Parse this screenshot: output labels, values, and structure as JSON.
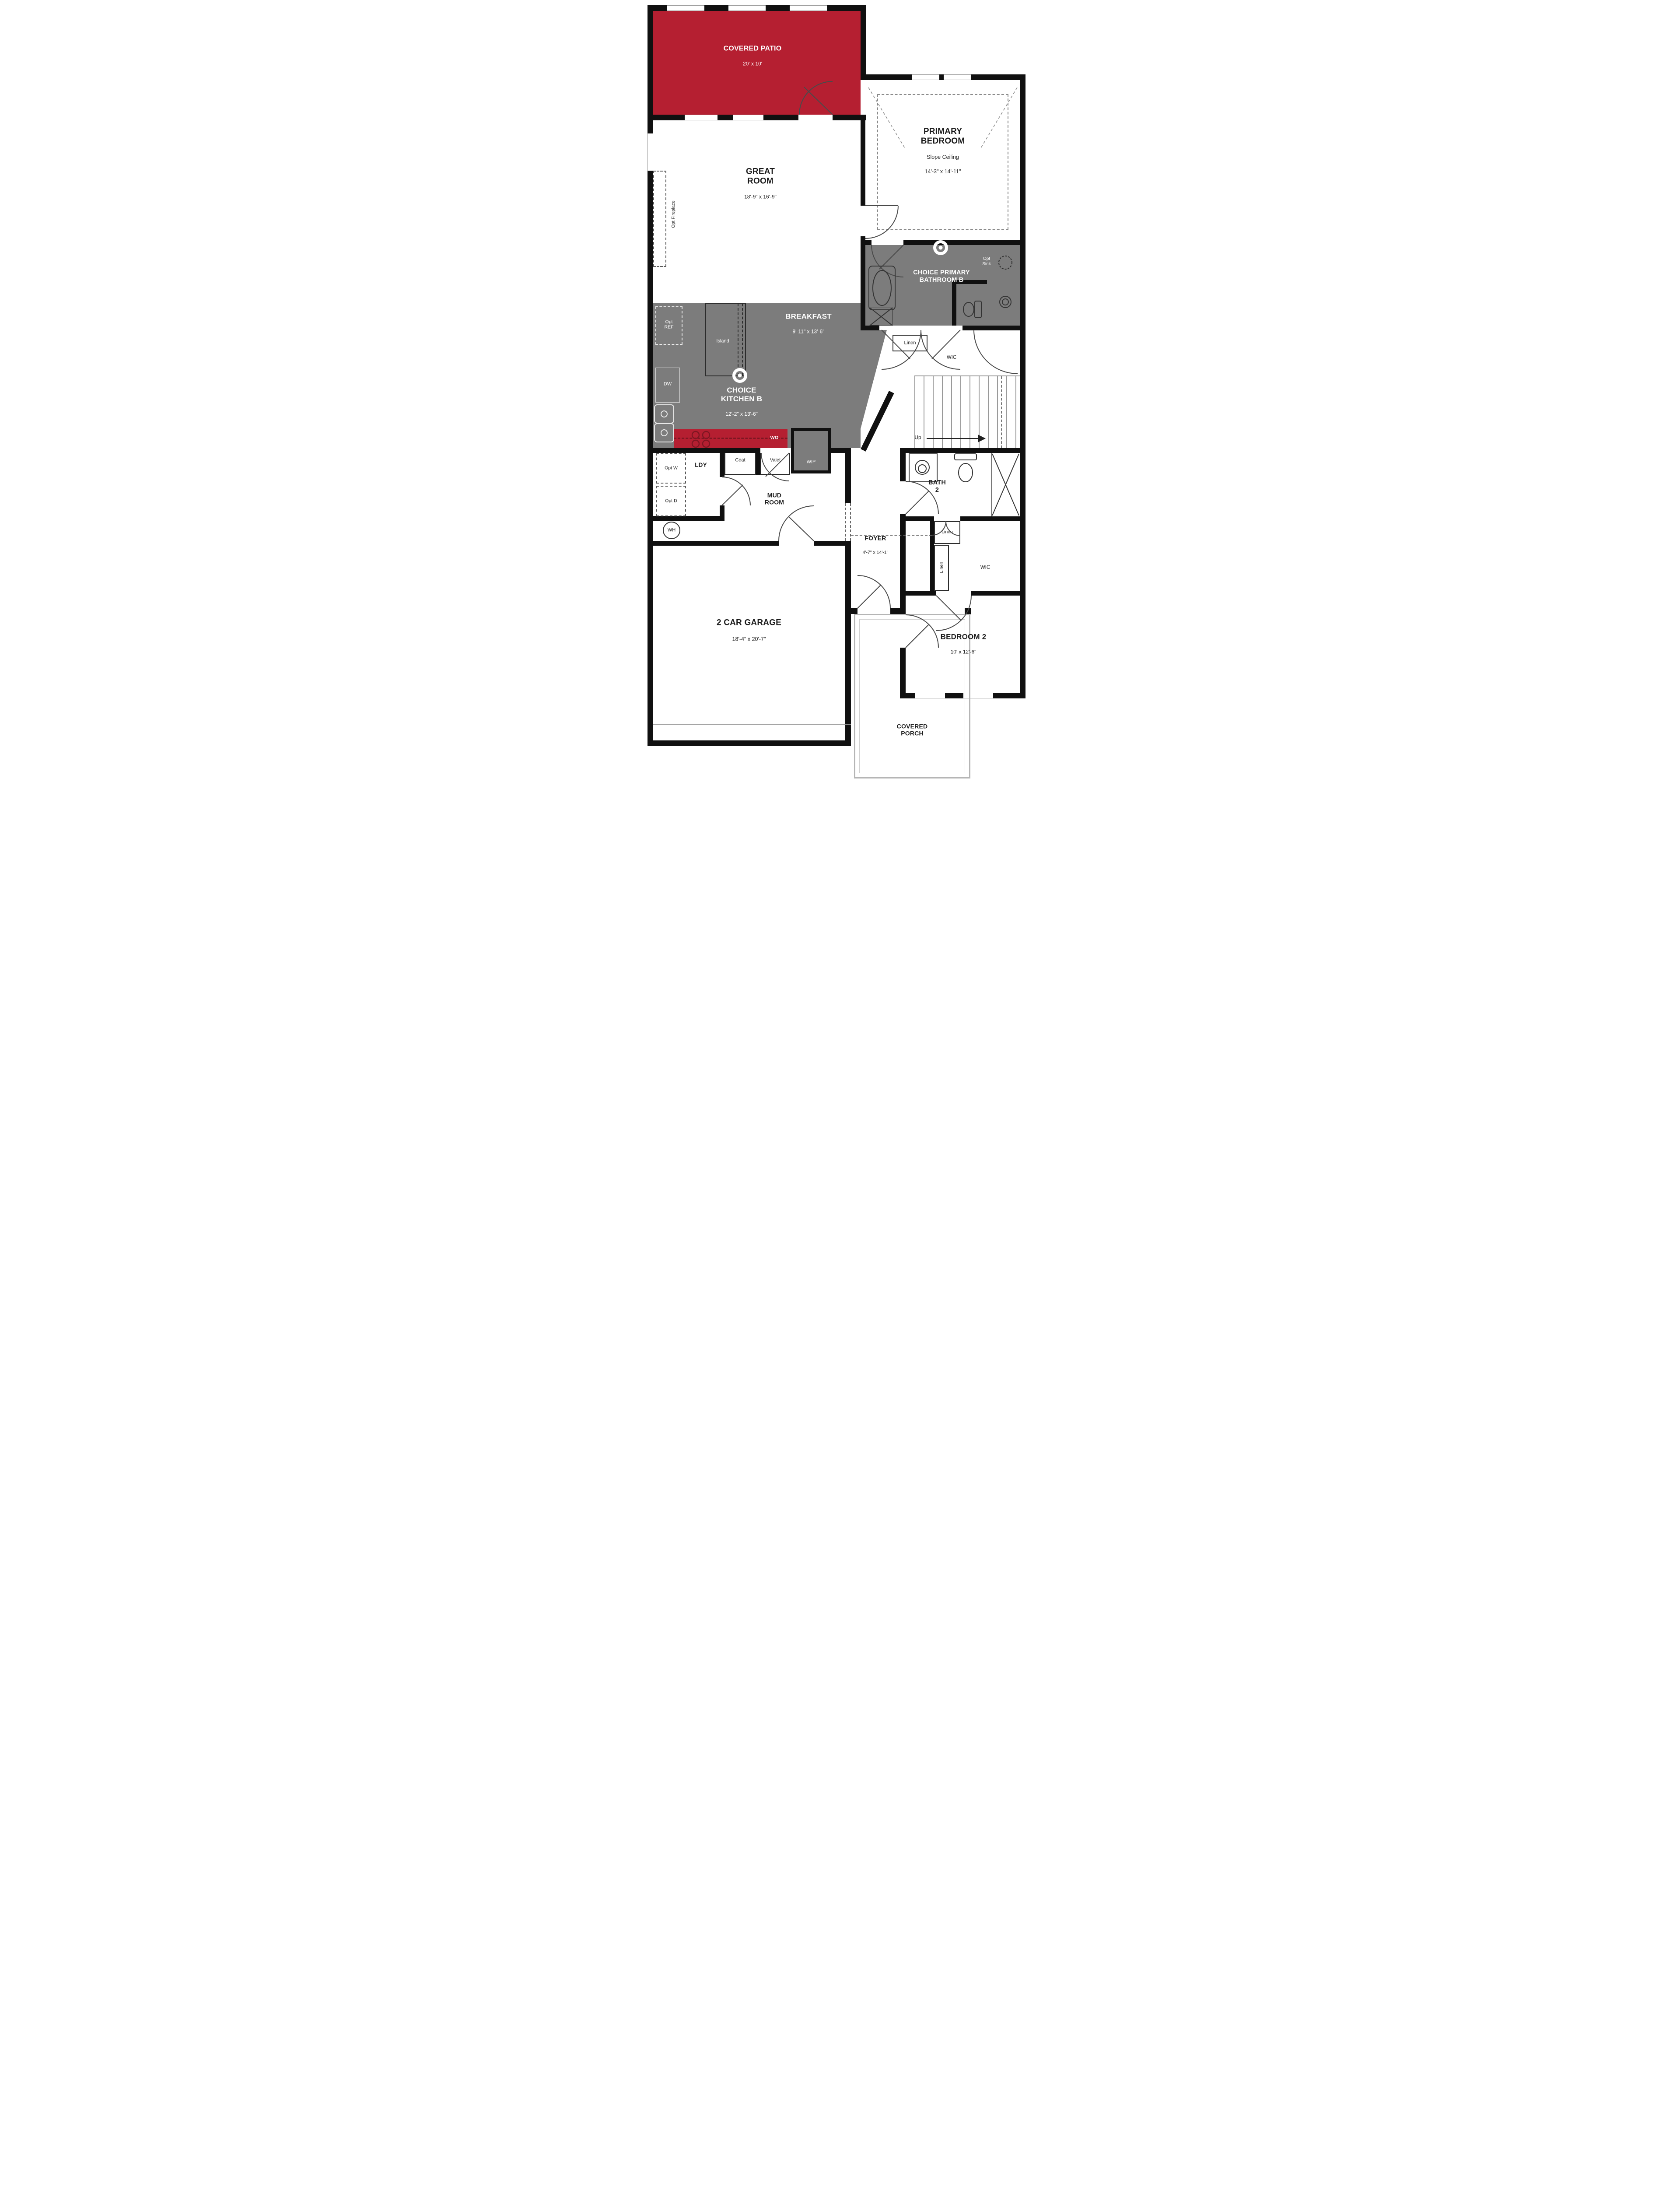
{
  "title": "First Floor Plan",
  "colors": {
    "accent_red": "#b51f31",
    "counter_dash_red": "#7e1622",
    "room_gray": "#7c7c7c",
    "wall_black": "#101010"
  },
  "rooms": {
    "covered_patio": {
      "name": "COVERED PATIO",
      "dims": "20' x 10'"
    },
    "great_room": {
      "name": "GREAT ROOM",
      "dims": "18'-9\" x 16'-9\""
    },
    "primary_bedroom": {
      "name": "PRIMARY BEDROOM",
      "note": "Slope Ceiling",
      "dims": "14'-3\" x 14'-11\""
    },
    "primary_bathroom": {
      "name": "CHOICE PRIMARY BATHROOM B"
    },
    "breakfast": {
      "name": "BREAKFAST",
      "dims": "9'-11\" x 13'-6\""
    },
    "kitchen": {
      "name": "CHOICE KITCHEN B",
      "dims": "12'-2\" x 13'-6\""
    },
    "mud_room": {
      "name": "MUD ROOM"
    },
    "foyer": {
      "name": "FOYER",
      "dims": "4'-7\" x 14'-1\""
    },
    "bath_2": {
      "name": "BATH 2"
    },
    "bedroom_2": {
      "name": "BEDROOM 2",
      "dims": "10' x 12'-6\""
    },
    "garage": {
      "name": "2 CAR GARAGE",
      "dims": "18'-4\" x 20'-7\""
    },
    "covered_porch": {
      "name": "COVERED PORCH"
    }
  },
  "labels": {
    "opt_fireplace": "Opt Fireplace",
    "opt_ref": "Opt REF",
    "dw": "DW",
    "island": "Island",
    "wo": "WO",
    "wip": "WIP",
    "ldy": "LDY",
    "coat": "Coat",
    "valet": "Valet",
    "opt_w": "Opt W",
    "opt_d": "Opt D",
    "wh": "WH",
    "up": "Up",
    "linen": "Linen",
    "wic": "WIC",
    "opt_sink": "Opt Sink"
  }
}
